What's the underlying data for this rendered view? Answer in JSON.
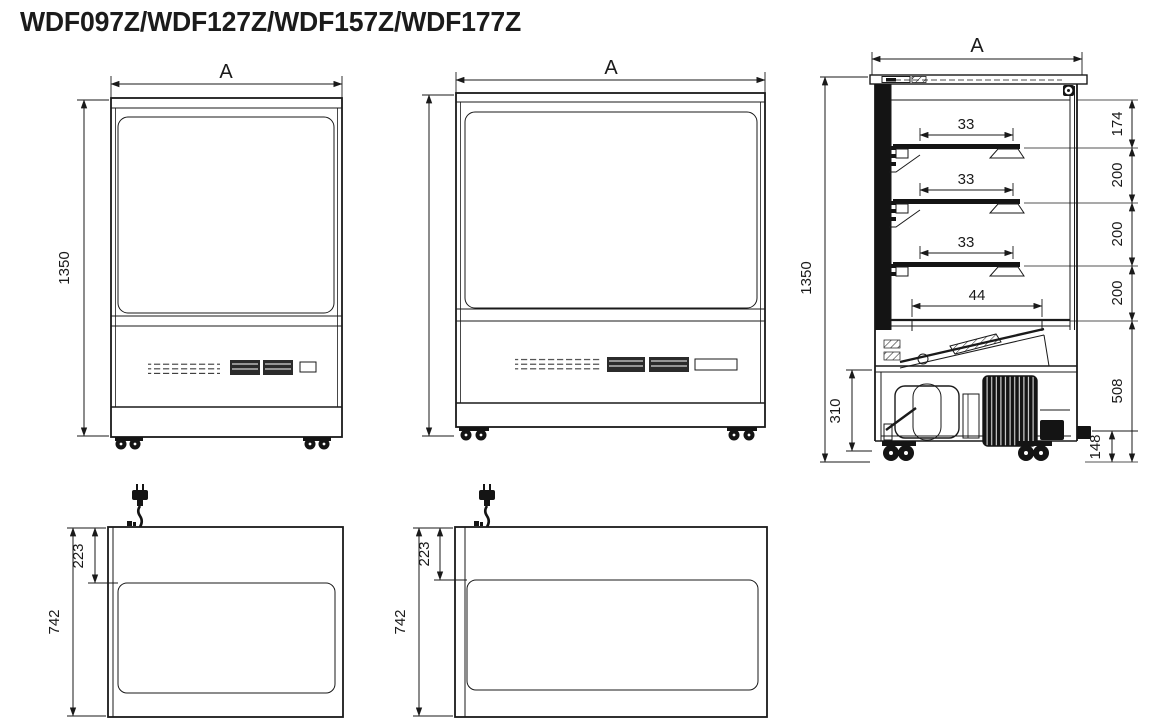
{
  "title": "WDF097Z/WDF127Z/WDF157Z/WDF177Z",
  "colors": {
    "line": "#1a1a1a",
    "background": "#ffffff"
  },
  "front_narrow": {
    "width_dim": "A",
    "height_dim": "1350"
  },
  "front_wide": {
    "width_dim": "A"
  },
  "side": {
    "width_dim": "A",
    "height_dim": "1350",
    "shelf_dims": [
      "33",
      "33",
      "33"
    ],
    "deck_dim": "44",
    "right_dims": [
      "174",
      "200",
      "200",
      "200",
      "508"
    ],
    "base_dim": "148",
    "machine_dim": "310"
  },
  "plan_narrow": {
    "depth_dim": "742",
    "offset_dim": "223"
  },
  "plan_wide": {
    "depth_dim": "742",
    "offset_dim": "223"
  }
}
